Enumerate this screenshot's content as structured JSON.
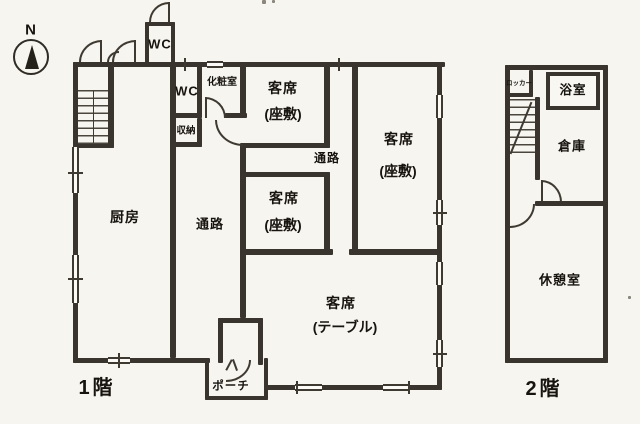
{
  "compass": {
    "label": "N"
  },
  "floor1": {
    "title": "1階",
    "rooms": {
      "wc_top": "WC",
      "wc_inner": "WC",
      "powder": "化粧室",
      "storage": "収納",
      "kitchen": "厨房",
      "corridor_left": "通路",
      "corridor_mid": "通路",
      "zashiki_top_1": "客席",
      "zashiki_top_2": "(座敷)",
      "zashiki_mid_1": "客席",
      "zashiki_mid_2": "(座敷)",
      "zashiki_right_1": "客席",
      "zashiki_right_2": "(座敷)",
      "table_1": "客席",
      "table_2": "(テーブル)",
      "porch": "ポーチ"
    }
  },
  "floor2": {
    "title": "2階",
    "rooms": {
      "locker": "ロッカー",
      "bath": "浴室",
      "warehouse": "倉庫",
      "rest": "休憩室"
    }
  }
}
